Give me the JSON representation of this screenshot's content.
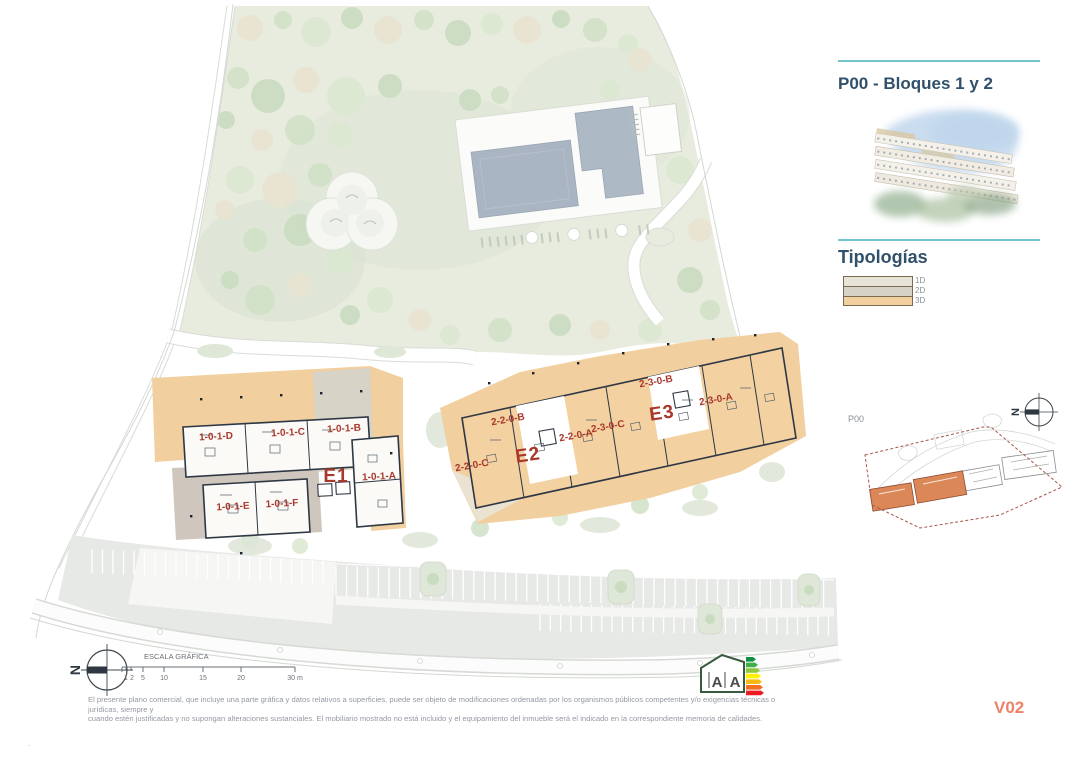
{
  "sidebar": {
    "title": "P00 - Bloques 1 y 2",
    "section_title": "Tipologías",
    "legend": [
      {
        "label": "1D",
        "color": "#e7e3d7"
      },
      {
        "label": "2D",
        "color": "#d6d2c6"
      },
      {
        "label": "3D",
        "color": "#f1cf9f"
      }
    ]
  },
  "plan": {
    "label_color": "#a8382c",
    "blocks": [
      {
        "text": "E1"
      },
      {
        "text": "E2"
      },
      {
        "text": "E3"
      }
    ],
    "units": [
      {
        "text": "1-0-1-D"
      },
      {
        "text": "1-0-1-C"
      },
      {
        "text": "1-0-1-B"
      },
      {
        "text": "1-0-1-A"
      },
      {
        "text": "1-0-1-E"
      },
      {
        "text": "1-0-1-F"
      },
      {
        "text": "2-2-0-B"
      },
      {
        "text": "2-2-0-A"
      },
      {
        "text": "2-2-0-C"
      },
      {
        "text": "2-3-0-B"
      },
      {
        "text": "2-3-0-C"
      },
      {
        "text": "2-3-0-A"
      }
    ]
  },
  "keymap": {
    "plane_label": "P00",
    "north_letter": "N",
    "highlight_color": "#dc8757",
    "boundary_color": "#a8554a"
  },
  "footer": {
    "north_letter": "N",
    "scale": {
      "title": "ESCALA GRÁFICA",
      "ticks": [
        "1",
        "2",
        "5",
        "10",
        "15",
        "20",
        "30 m"
      ]
    },
    "disclaimer_line1": "El presente plano comercial, que incluye una parte gráfica y datos relativos a superficies, puede ser objeto de modificaciones ordenadas por los organismos públicos competentes y/o exigencias técnicas o jurídicas, siempre y",
    "disclaimer_line2": "cuando estén justificadas y no supongan alteraciones sustanciales. El mobiliario mostrado no está incluido y el equipamiento del inmueble será el indicado en la correspondiente memoria de calidades.",
    "energy": {
      "left": "A",
      "right": "A"
    },
    "version": "V02",
    "corner_mark": "."
  }
}
